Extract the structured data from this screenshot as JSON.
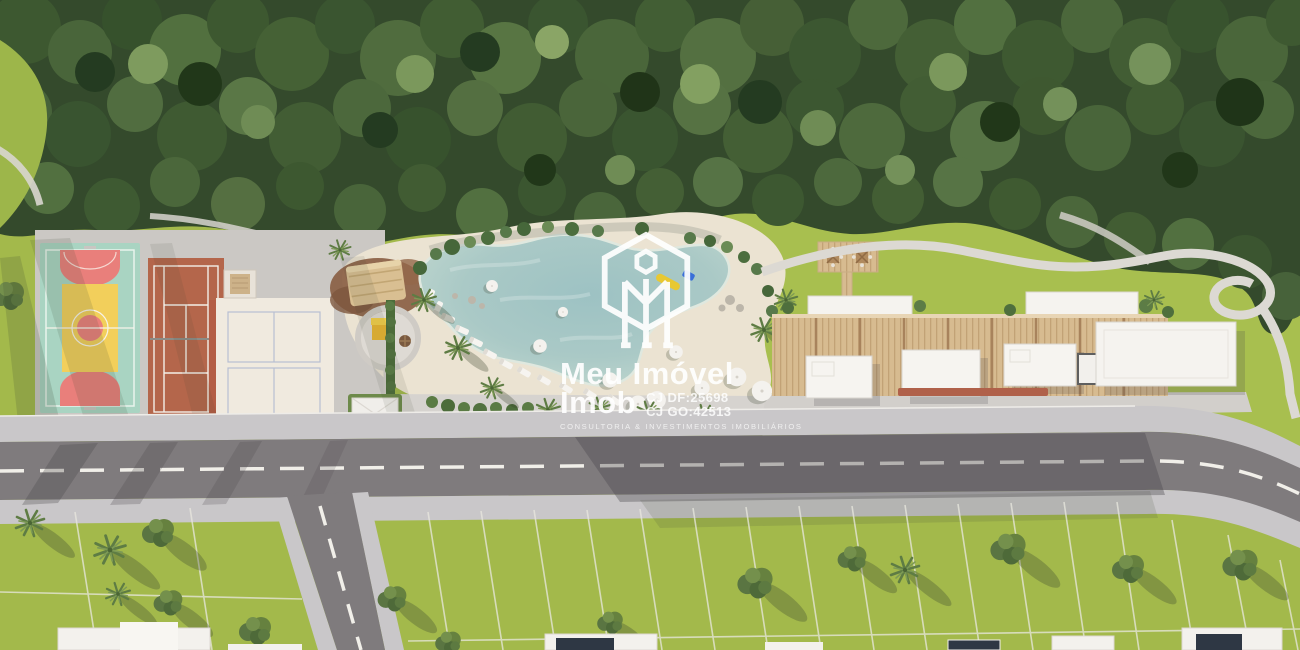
{
  "watermark": {
    "brand_line1": "Meu Imóvel",
    "brand_line2": "Imob",
    "registration_df": "CJ DF:25698",
    "registration_go": "CJ GO:42513",
    "tagline": "CONSULTORIA & INVESTIMENTOS IMOBILIÁRIOS",
    "text_color": "#ffffff"
  },
  "scene": {
    "type": "aerial-masterplan-render",
    "subject": "Condominium leisure area with forest, lagoon pool, sports courts, clubhouse and residential lots",
    "features": [
      "forest",
      "multi-sport-court",
      "tennis-clay-court",
      "beach-volleyball-court",
      "thatched-hut",
      "playground",
      "lagoon-pool",
      "sand-beach",
      "picnic-deck",
      "clubhouse-pergola",
      "walking-loop-path",
      "street",
      "residential-lots"
    ],
    "palette": {
      "forest_green": "#344a2c",
      "lawn_green": "#a3b94b",
      "bright_lawn": "#a8bf4f",
      "sand": "#ebe3d2",
      "pool_water": "#aac9c6",
      "clay_court": "#b4664b",
      "sport_court_teal": "#a9d4c2",
      "sport_court_yellow": "#f2cf5b",
      "sport_court_pink": "#e97f7b",
      "asphalt": "#7f7b7d",
      "sidewalk": "#c9c7c9",
      "wood": "#d7bb90",
      "roof_white": "#f5f3ef"
    }
  }
}
